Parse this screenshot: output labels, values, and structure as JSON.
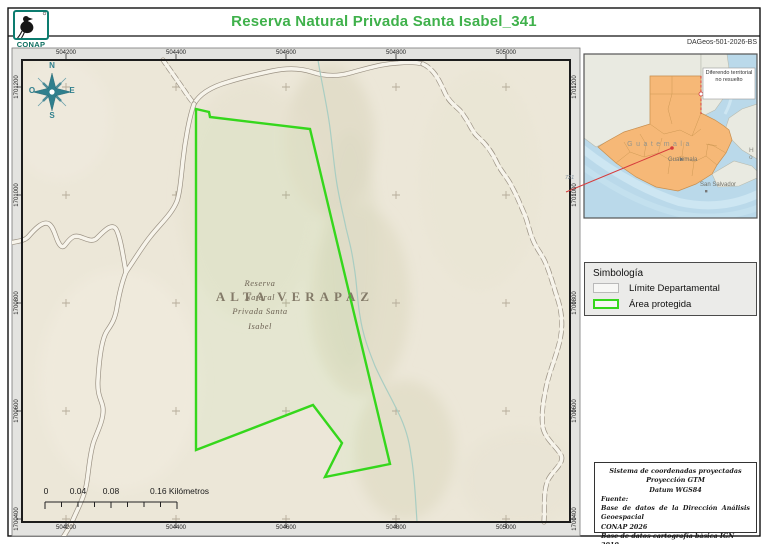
{
  "header": {
    "logo_caption": "CONAP",
    "title": "Reserva Natural Privada Santa Isabel_341",
    "doc_code": "DAGeos-501-2026-BS"
  },
  "map": {
    "top_coords": [
      "504200",
      "504400",
      "504600",
      "504800",
      "505000"
    ],
    "bottom_coords": [
      "504200",
      "504400",
      "504600",
      "504800",
      "505000"
    ],
    "left_coords": [
      "1701200",
      "1701000",
      "1700800",
      "1700600",
      "1700400"
    ],
    "right_coords": [
      "1701200",
      "1701000",
      "1700800",
      "1700600",
      "1700400"
    ],
    "department_label": "ALTA VERAPAZ",
    "reserve_label": {
      "line1": "Reserva",
      "line2": "Natural",
      "line3": "Privada Santa",
      "line4": "Isabel"
    },
    "compass": {
      "north": "N",
      "east": "E",
      "south": "S",
      "west": "O"
    },
    "scalebar": {
      "zero": "0",
      "k1": "0.04",
      "k2": "0.08",
      "k3": "0.16 Kilómetros"
    }
  },
  "inset": {
    "country_label": "Guatemala",
    "city_label": "Guatemala",
    "san_salvador_label": "San Salvador",
    "honduras_label": "H o",
    "note": "Diferendo territorial no resuelto",
    "depth_label": "721"
  },
  "legend": {
    "title": "Simbología",
    "items": [
      {
        "label": "Límite Departamental",
        "swatch_color": "#b9b9b9"
      },
      {
        "label": "Área protegida",
        "swatch_color": "#35d71c"
      }
    ]
  },
  "credits": {
    "line1": "Sistema de coordenadas proyectadas",
    "line2": "Proyección GTM",
    "line3": "Datum WGS84",
    "fuente": "Fuente:",
    "source1": "Base de datos de la Dirección Análisis Geoespacial",
    "source2": "CONAP 2026",
    "source3": "Base de datos cartografía básica IGN 2010"
  },
  "colors": {
    "title_green": "#3fb14b",
    "conap_teal": "#0b7d6e",
    "protected_area_green": "#35d71c",
    "guatemala_orange": "#f6b877",
    "leader_red": "#d63c3c",
    "map_background": "#ece7d8"
  }
}
